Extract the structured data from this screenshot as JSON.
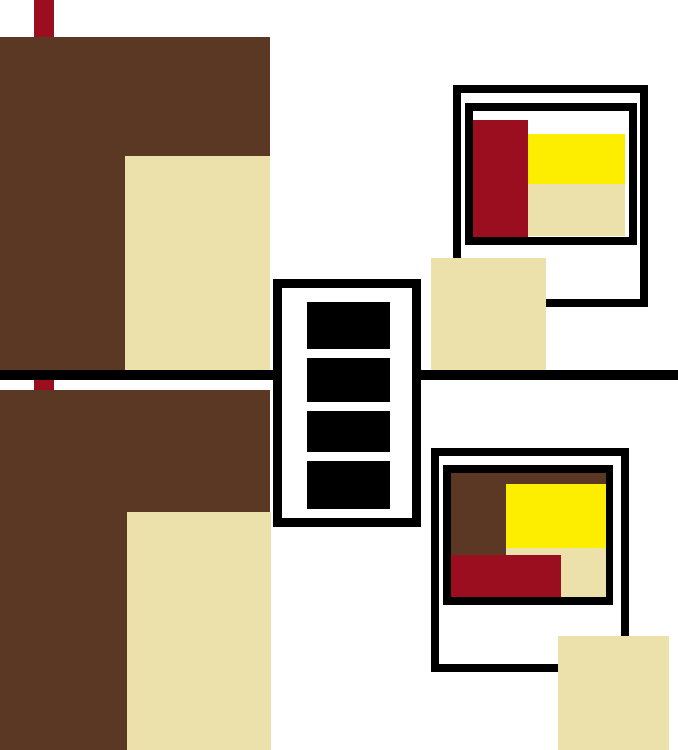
{
  "canvas": {
    "width": 678,
    "height": 750,
    "background": "#ffffff"
  },
  "palette": {
    "white": "#ffffff",
    "black": "#000000",
    "brown": "#5a3823",
    "red": "#9a0e1f",
    "yellow": "#fdee00",
    "cream": "#ede1ab"
  },
  "shapes": [
    {
      "name": "top-red-stripe",
      "x": 34,
      "y": 0,
      "w": 20,
      "h": 37,
      "fill": "red"
    },
    {
      "name": "upper-brown-block",
      "x": 0,
      "y": 37,
      "w": 270,
      "h": 333,
      "fill": "brown"
    },
    {
      "name": "upper-cream-block",
      "x": 125,
      "y": 156,
      "w": 145,
      "h": 214,
      "fill": "cream"
    },
    {
      "name": "lower-red-stripe",
      "x": 34,
      "y": 380,
      "w": 20,
      "h": 10,
      "fill": "red"
    },
    {
      "name": "lower-brown-block",
      "x": 0,
      "y": 390,
      "w": 270,
      "h": 360,
      "fill": "brown"
    },
    {
      "name": "lower-cream-block",
      "x": 127,
      "y": 512,
      "w": 144,
      "h": 238,
      "fill": "cream"
    },
    {
      "name": "horizontal-divider-line",
      "x": 0,
      "y": 370,
      "w": 678,
      "h": 10,
      "fill": "black"
    },
    {
      "name": "top-polaroid-outer-frame",
      "x": 453,
      "y": 85,
      "w": 195,
      "h": 222,
      "fill": "white",
      "border": 8
    },
    {
      "name": "top-polaroid-inner-frame",
      "x": 465,
      "y": 103,
      "w": 172,
      "h": 142,
      "fill": "white",
      "border": 8
    },
    {
      "name": "top-polaroid-red-rect",
      "x": 473,
      "y": 120,
      "w": 55,
      "h": 117,
      "fill": "red"
    },
    {
      "name": "top-polaroid-yellow-rect",
      "x": 528,
      "y": 134,
      "w": 97,
      "h": 50,
      "fill": "yellow"
    },
    {
      "name": "top-polaroid-cream-rect",
      "x": 528,
      "y": 184,
      "w": 97,
      "h": 52,
      "fill": "cream"
    },
    {
      "name": "middle-cream-square",
      "x": 431,
      "y": 258,
      "w": 115,
      "h": 112,
      "fill": "cream"
    },
    {
      "name": "filmstrip-box",
      "x": 273,
      "y": 279,
      "w": 148,
      "h": 248,
      "fill": "white",
      "border": 9
    },
    {
      "name": "filmstrip-frame-1",
      "x": 307,
      "y": 302,
      "w": 83,
      "h": 47,
      "fill": "black"
    },
    {
      "name": "filmstrip-frame-2",
      "x": 307,
      "y": 358,
      "w": 83,
      "h": 44,
      "fill": "black"
    },
    {
      "name": "filmstrip-frame-3",
      "x": 307,
      "y": 411,
      "w": 83,
      "h": 41,
      "fill": "black"
    },
    {
      "name": "filmstrip-frame-4",
      "x": 307,
      "y": 461,
      "w": 83,
      "h": 48,
      "fill": "black"
    },
    {
      "name": "bottom-polaroid-outer-frame",
      "x": 431,
      "y": 448,
      "w": 198,
      "h": 224,
      "fill": "white",
      "border": 8
    },
    {
      "name": "bottom-polaroid-inner-frame",
      "x": 443,
      "y": 465,
      "w": 170,
      "h": 140,
      "fill": "white",
      "border": 8
    },
    {
      "name": "bottom-polaroid-brown-rect",
      "x": 451,
      "y": 473,
      "w": 155,
      "h": 82,
      "fill": "brown"
    },
    {
      "name": "bottom-polaroid-yellow-rect",
      "x": 506,
      "y": 484,
      "w": 100,
      "h": 64,
      "fill": "yellow"
    },
    {
      "name": "bottom-polaroid-cream-rect",
      "x": 506,
      "y": 548,
      "w": 100,
      "h": 49,
      "fill": "cream"
    },
    {
      "name": "bottom-polaroid-red-rect",
      "x": 451,
      "y": 555,
      "w": 110,
      "h": 42,
      "fill": "red"
    },
    {
      "name": "bottom-cream-square",
      "x": 558,
      "y": 636,
      "w": 111,
      "h": 114,
      "fill": "cream"
    }
  ]
}
